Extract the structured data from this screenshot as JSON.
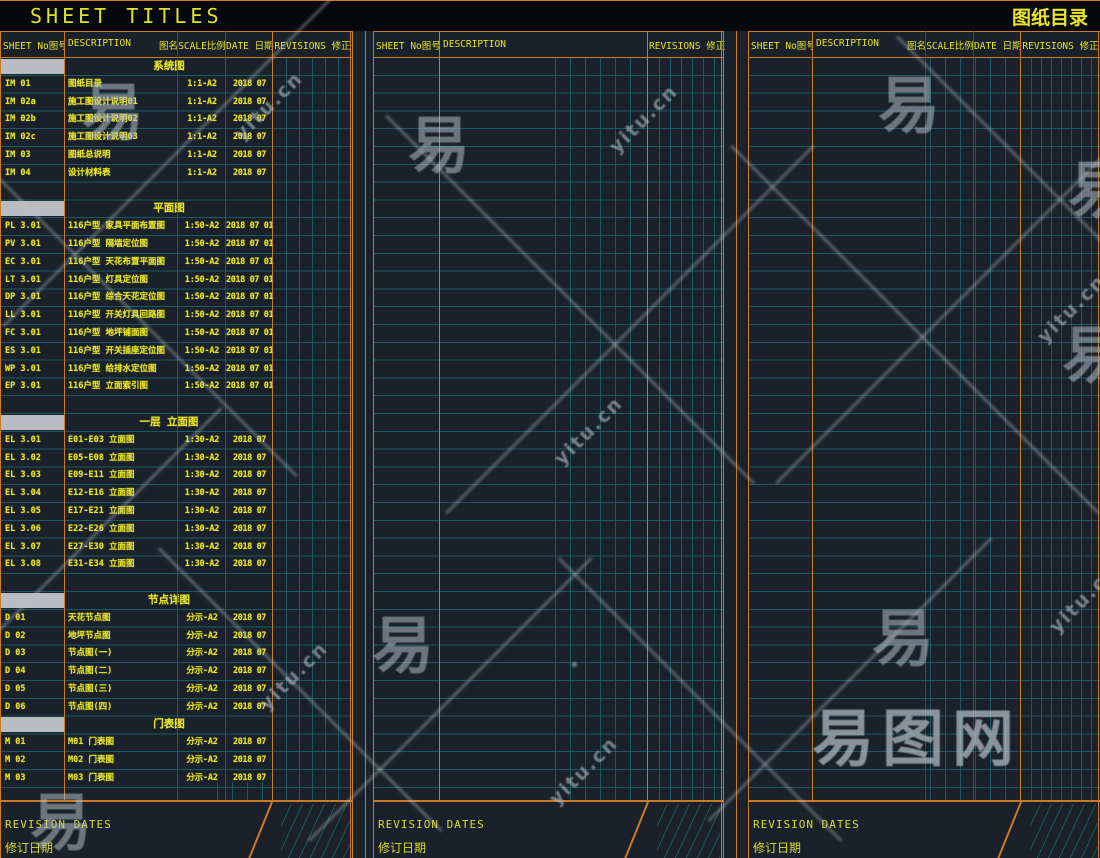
{
  "title_bar": {
    "left": "SHEET TITLES",
    "right": "图纸目录"
  },
  "columns": {
    "sheet_no": "SHEET No图号",
    "description": "DESCRIPTION",
    "description_cn": "图名",
    "scale": "SCALE比例",
    "date": "DATE 日期",
    "revisions": "REVISIONS 修正"
  },
  "footer": {
    "en": "REVISION DATES",
    "cn": "修订日期"
  },
  "watermark": {
    "url_text": "yitu.cn",
    "char": "易",
    "logo": "易图网"
  },
  "colors": {
    "accent_orange": "#c87a28",
    "grid_teal": "#1a646a",
    "text_yellow": "#e6e428",
    "band_gray": "#b9bcc0",
    "background": "#1a212a"
  },
  "chart_data": {
    "type": "table",
    "title": "图纸目录 (Sheet Titles Index)",
    "columns": [
      "SHEET No图号",
      "DESCRIPTION 图名",
      "SCALE比例",
      "DATE 日期",
      "REVISIONS 修正"
    ]
  },
  "sheet_index": {
    "sections": [
      {
        "title": "系统图",
        "gap_before": false,
        "rows": [
          {
            "no": "IM 01",
            "desc": "图纸目录",
            "scale": "1:1-A2",
            "date": "2018 07"
          },
          {
            "no": "IM 02a",
            "desc": "施工图设计说明01",
            "scale": "1:1-A2",
            "date": "2018 07"
          },
          {
            "no": "IM 02b",
            "desc": "施工图设计说明02",
            "scale": "1:1-A2",
            "date": "2018 07"
          },
          {
            "no": "IM 02c",
            "desc": "施工图设计说明03",
            "scale": "1:1-A2",
            "date": "2018 07"
          },
          {
            "no": "IM 03",
            "desc": "图纸总说明",
            "scale": "1:1-A2",
            "date": "2018 07"
          },
          {
            "no": "IM 04",
            "desc": "设计材料表",
            "scale": "1:1-A2",
            "date": "2018 07"
          }
        ]
      },
      {
        "title": "平面图",
        "gap_before": true,
        "rows": [
          {
            "no": "PL 3.01",
            "desc": "116户型 家具平面布置图",
            "scale": "1:50-A2",
            "date": "2018 07 01"
          },
          {
            "no": "PV 3.01",
            "desc": "116户型 隔墙定位图",
            "scale": "1:50-A2",
            "date": "2018 07 01"
          },
          {
            "no": "EC 3.01",
            "desc": "116户型 天花布置平面图",
            "scale": "1:50-A2",
            "date": "2018 07 01"
          },
          {
            "no": "LT 3.01",
            "desc": "116户型 灯具定位图",
            "scale": "1:50-A2",
            "date": "2018 07 01"
          },
          {
            "no": "DP 3.01",
            "desc": "116户型 综合天花定位图",
            "scale": "1:50-A2",
            "date": "2018 07 01"
          },
          {
            "no": "LL 3.01",
            "desc": "116户型 开关灯具回路图",
            "scale": "1:50-A2",
            "date": "2018 07 01"
          },
          {
            "no": "FC 3.01",
            "desc": "116户型 地坪铺面图",
            "scale": "1:50-A2",
            "date": "2018 07 01"
          },
          {
            "no": "ES 3.01",
            "desc": "116户型 开关插座定位图",
            "scale": "1:50-A2",
            "date": "2018 07 01"
          },
          {
            "no": "WP 3.01",
            "desc": "116户型 给排水定位图",
            "scale": "1:50-A2",
            "date": "2018 07 01"
          },
          {
            "no": "EP 3.01",
            "desc": "116户型 立面索引图",
            "scale": "1:50-A2",
            "date": "2018 07 01"
          }
        ]
      },
      {
        "title": "一层 立面图",
        "gap_before": true,
        "rows": [
          {
            "no": "EL 3.01",
            "desc": "E01-E03 立面图",
            "scale": "1:30-A2",
            "date": "2018 07"
          },
          {
            "no": "EL 3.02",
            "desc": "E05-E08 立面图",
            "scale": "1:30-A2",
            "date": "2018 07"
          },
          {
            "no": "EL 3.03",
            "desc": "E09-E11 立面图",
            "scale": "1:30-A2",
            "date": "2018 07"
          },
          {
            "no": "EL 3.04",
            "desc": "E12-E16 立面图",
            "scale": "1:30-A2",
            "date": "2018 07"
          },
          {
            "no": "EL 3.05",
            "desc": "E17-E21 立面图",
            "scale": "1:30-A2",
            "date": "2018 07"
          },
          {
            "no": "EL 3.06",
            "desc": "E22-E26 立面图",
            "scale": "1:30-A2",
            "date": "2018 07"
          },
          {
            "no": "EL 3.07",
            "desc": "E27-E30 立面图",
            "scale": "1:30-A2",
            "date": "2018 07"
          },
          {
            "no": "EL 3.08",
            "desc": "E31-E34 立面图",
            "scale": "1:30-A2",
            "date": "2018 07"
          }
        ]
      },
      {
        "title": "节点详图",
        "gap_before": true,
        "rows": [
          {
            "no": "D 01",
            "desc": "天花节点图",
            "scale": "分示-A2",
            "date": "2018 07"
          },
          {
            "no": "D 02",
            "desc": "地坪节点图",
            "scale": "分示-A2",
            "date": "2018 07"
          },
          {
            "no": "D 03",
            "desc": "节点图(一)",
            "scale": "分示-A2",
            "date": "2018 07"
          },
          {
            "no": "D 04",
            "desc": "节点图(二)",
            "scale": "分示-A2",
            "date": "2018 07"
          },
          {
            "no": "D 05",
            "desc": "节点图(三)",
            "scale": "分示-A2",
            "date": "2018 07"
          },
          {
            "no": "D 06",
            "desc": "节点图(四)",
            "scale": "分示-A2",
            "date": "2018 07"
          }
        ]
      },
      {
        "title": "门表图",
        "gap_before": false,
        "rows": [
          {
            "no": "M 01",
            "desc": "M01 门表图",
            "scale": "分示-A2",
            "date": "2018 07"
          },
          {
            "no": "M 02",
            "desc": "M02 门表图",
            "scale": "分示-A2",
            "date": "2018 07"
          },
          {
            "no": "M 03",
            "desc": "M03 门表图",
            "scale": "分示-A2",
            "date": "2018 07"
          }
        ]
      }
    ]
  }
}
